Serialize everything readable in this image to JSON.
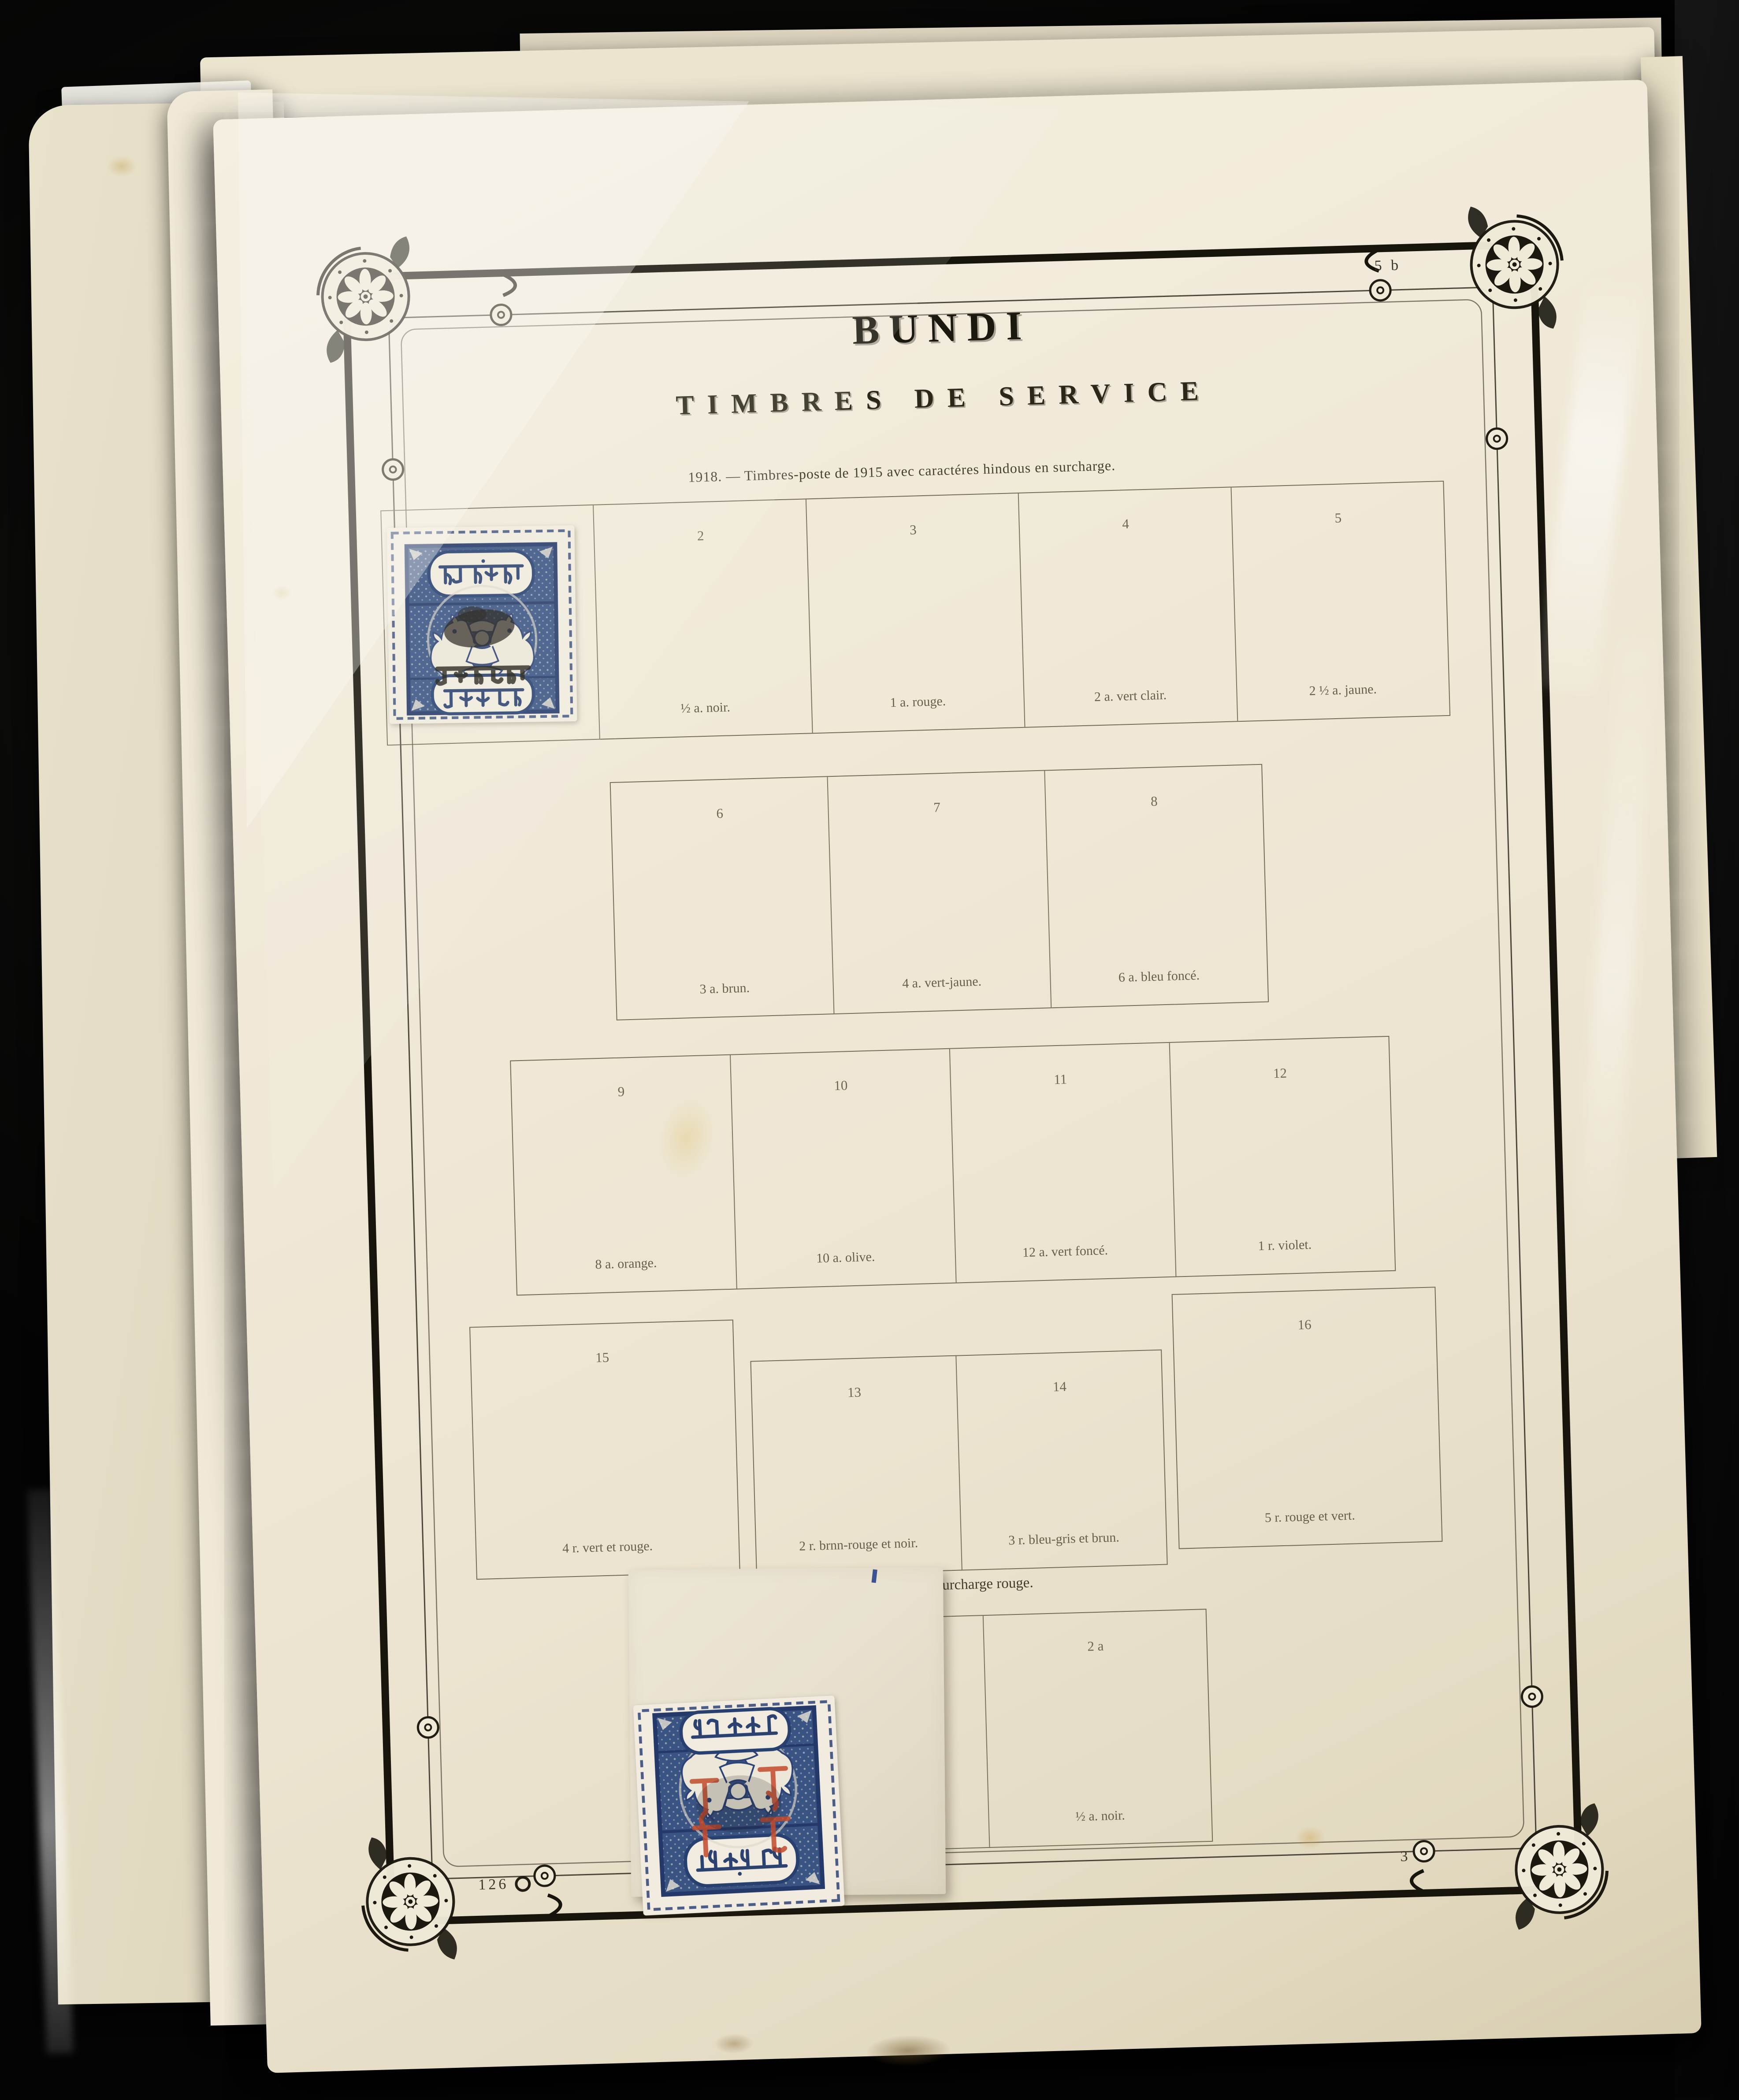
{
  "page": {
    "title": "BUNDI",
    "subtitle": "TIMBRES DE SERVICE",
    "section_header": "1918. — Timbres-poste de 1915 avec caractéres hindous en surcharge.",
    "surcharge_heading": "Surcharge rouge.",
    "corner_code_top_right": "5 b",
    "plate_number_bottom_left": "126",
    "page_number_bottom_right": "3",
    "paper_color": "#efe8d5",
    "frame_color": "#17140c",
    "label_color": "#66604a"
  },
  "rows": [
    {
      "cells": [
        {
          "number": "",
          "label": ""
        },
        {
          "number": "2",
          "label": "½ a. noir."
        },
        {
          "number": "3",
          "label": "1 a. rouge."
        },
        {
          "number": "4",
          "label": "2 a. vert clair."
        },
        {
          "number": "5",
          "label": "2 ½ a. jaune."
        }
      ]
    },
    {
      "cells": [
        {
          "number": "6",
          "label": "3 a. brun."
        },
        {
          "number": "7",
          "label": "4 a. vert-jaune."
        },
        {
          "number": "8",
          "label": "6 a. bleu foncé."
        }
      ]
    },
    {
      "cells": [
        {
          "number": "9",
          "label": "8 a. orange."
        },
        {
          "number": "10",
          "label": "10 a. olive."
        },
        {
          "number": "11",
          "label": "12 a. vert foncé."
        },
        {
          "number": "12",
          "label": "1 r. violet."
        }
      ]
    },
    {
      "cells": [
        {
          "number": "15",
          "label": "4 r. vert et rouge."
        },
        {
          "number": "13",
          "label": "2 r. brnn-rouge et noir."
        },
        {
          "number": "14",
          "label": "3 r. bleu-gris et brun."
        },
        {
          "number": "16",
          "label": "5 r. rouge et vert."
        }
      ]
    }
  ],
  "surcharge": {
    "cell_number": "2 a",
    "cell_label": "½ a. noir."
  },
  "stamps": {
    "top": {
      "inscription_top": "राज बूंदी",
      "inscription_bottom": "पाव आना",
      "ink_color": "#34507f",
      "overprint": "black service overprint"
    },
    "bottom": {
      "inscription_top": "राज बूंदी",
      "inscription_bottom": "पाव आना",
      "ink_color": "#2b3f6e",
      "overprint_color": "#c24a2c",
      "orientation": "inverted",
      "mounted_on": "piece"
    }
  }
}
